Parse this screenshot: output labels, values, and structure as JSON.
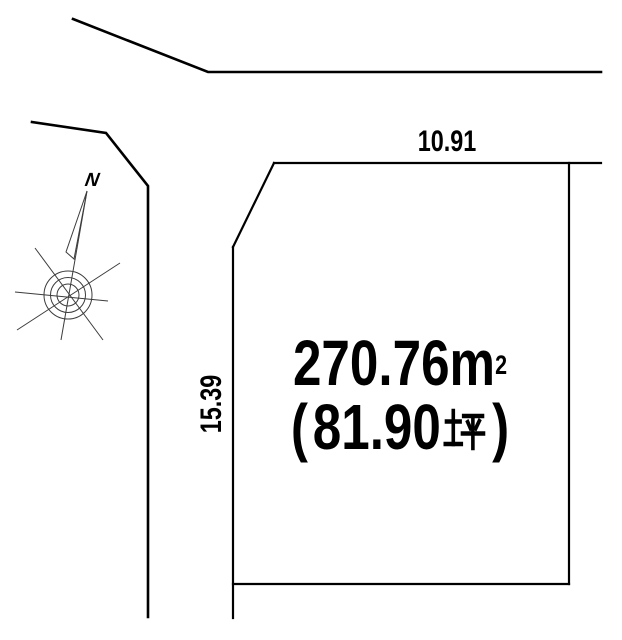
{
  "diagram": {
    "kind": "land-plot-diagram",
    "background_color": "#ffffff",
    "line_color": "#000000",
    "compass": {
      "north_label": "N"
    },
    "plot": {
      "area_m2": "270.76m²",
      "area_m2_base": "270.76m",
      "area_m2_sup": "2",
      "area_tsubo": "（81.90坪）",
      "area_tsubo_open": "(",
      "area_tsubo_value": "81.90",
      "area_tsubo_unit": "坪",
      "area_tsubo_close": ")",
      "dimension_top": "10.91",
      "dimension_left": "15.39"
    }
  }
}
